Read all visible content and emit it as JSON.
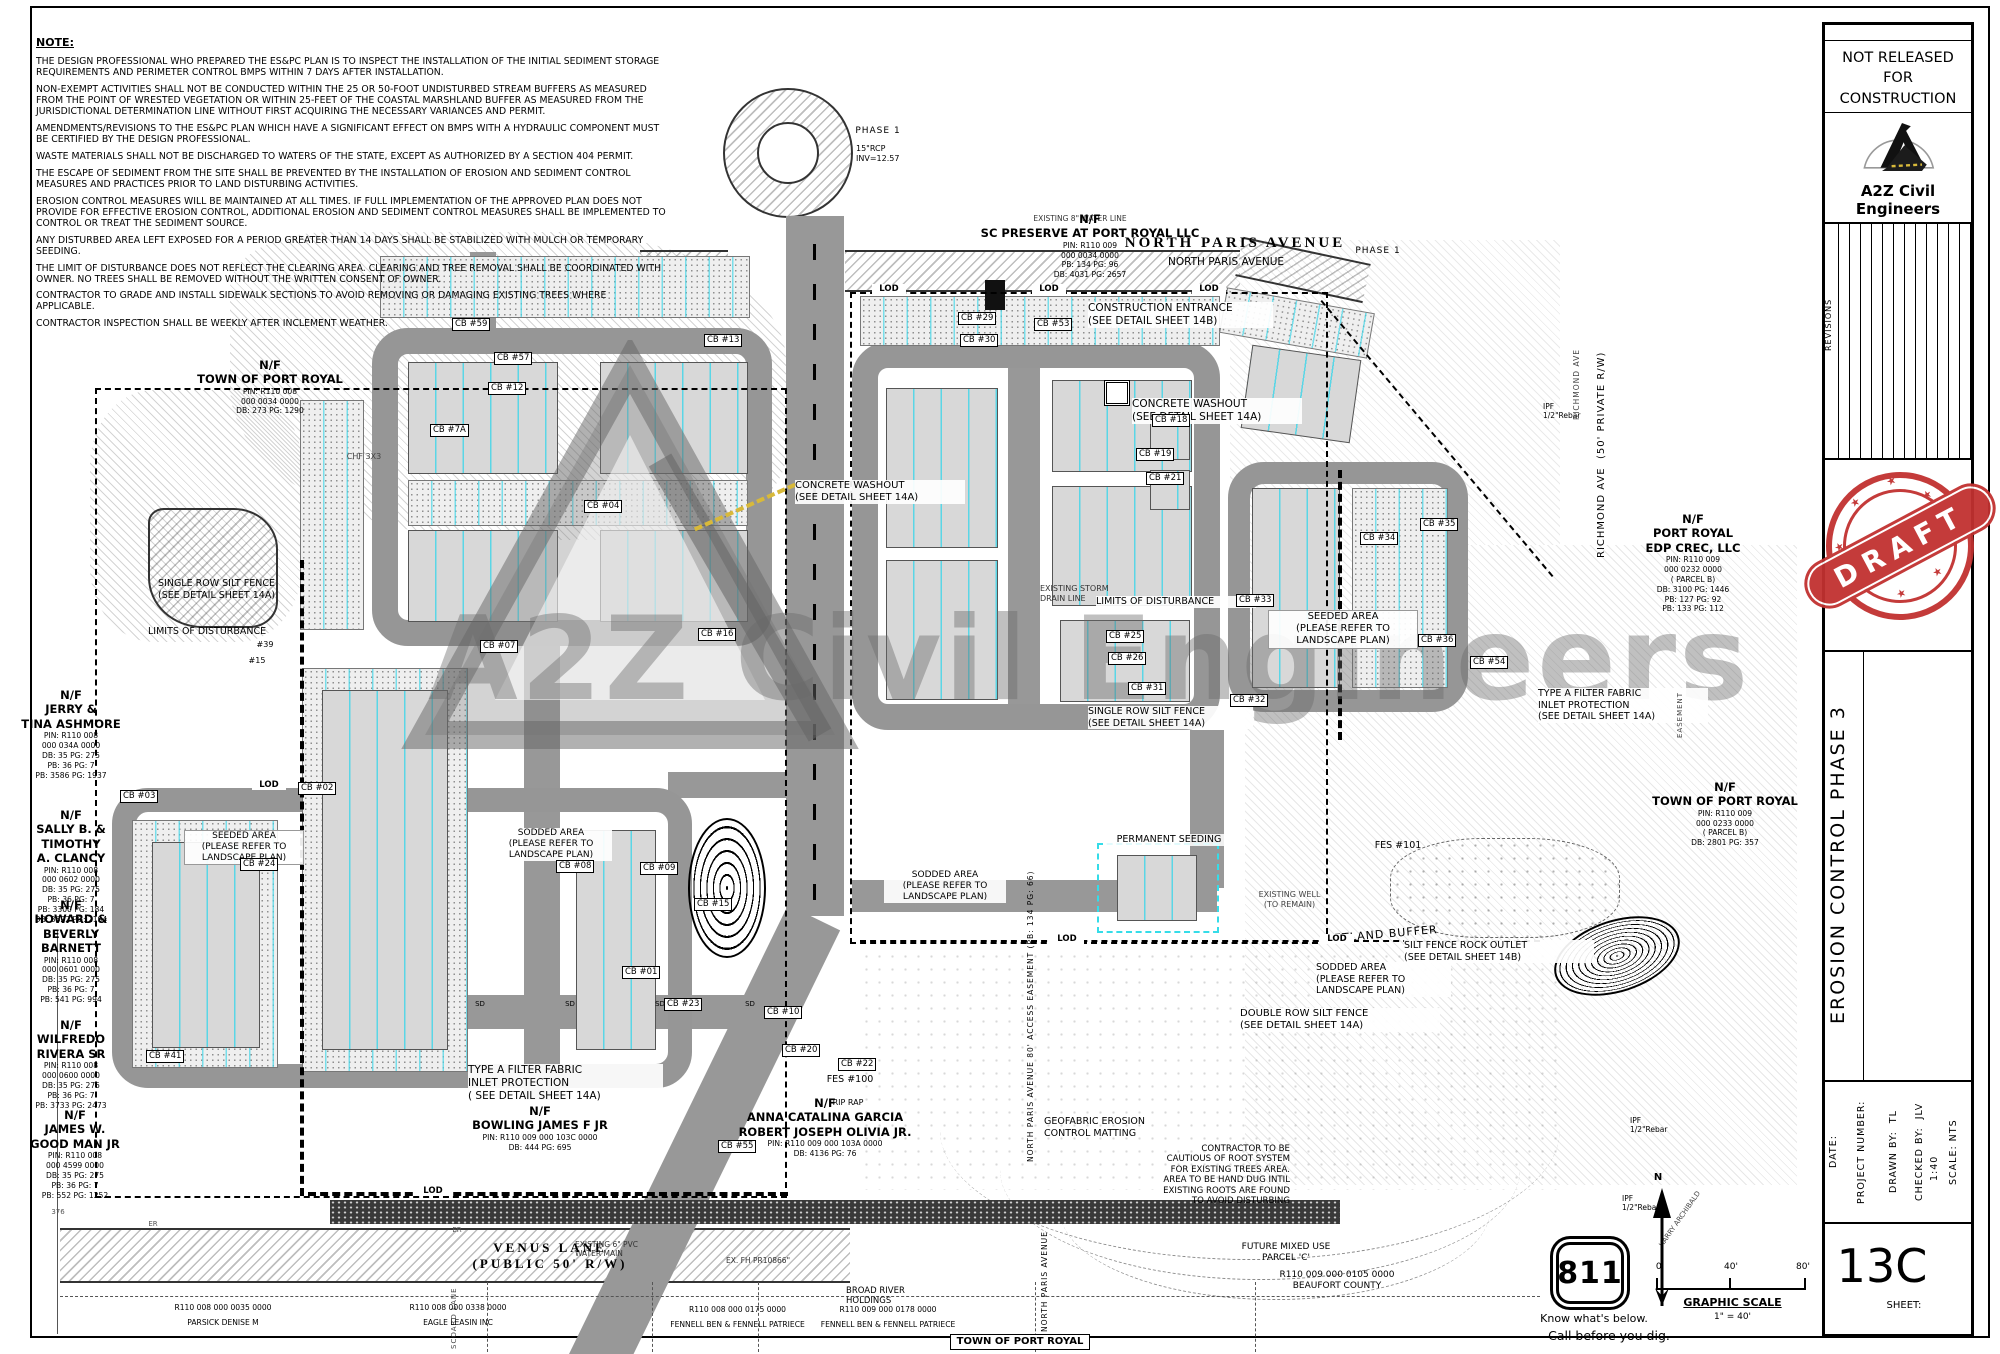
{
  "notes": {
    "title": "NOTE:",
    "items": [
      "THE DESIGN PROFESSIONAL WHO PREPARED THE ES&PC PLAN IS TO INSPECT THE INSTALLATION OF THE INITIAL SEDIMENT  STORAGE REQUIREMENTS AND PERIMETER CONTROL BMPS WITHIN 7 DAYS AFTER INSTALLATION.",
      "NON-EXEMPT ACTIVITIES SHALL NOT BE CONDUCTED WITHIN THE 25 OR 50-FOOT UNDISTURBED STREAM BUFFERS AS MEASURED FROM THE POINT OF WRESTED VEGETATION OR WITHIN 25-FEET OF THE COASTAL MARSHLAND BUFFER AS MEASURED FROM THE JURISDICTIONAL DETERMINATION LINE WITHOUT FIRST ACQUIRING THE NECESSARY VARIANCES AND PERMIT.",
      "AMENDMENTS/REVISIONS TO THE ES&PC PLAN WHICH HAVE A SIGNIFICANT EFFECT ON BMPS WITH A HYDRAULIC COMPONENT MUST BE CERTIFIED BY THE DESIGN PROFESSIONAL.",
      "WASTE MATERIALS SHALL NOT BE DISCHARGED TO WATERS OF THE STATE, EXCEPT AS AUTHORIZED BY A  SECTION 404 PERMIT.",
      "THE ESCAPE OF SEDIMENT FROM THE SITE SHALL BE PREVENTED BY THE INSTALLATION OF EROSION AND SEDIMENT CONTROL MEASURES AND PRACTICES PRIOR TO LAND DISTURBING ACTIVITIES.",
      "EROSION CONTROL MEASURES WILL BE MAINTAINED AT ALL TIMES.  IF FULL IMPLEMENTATION OF THE APPROVED PLAN DOES NOT PROVIDE FOR EFFECTIVE EROSION CONTROL, ADDITIONAL EROSION AND SEDIMENT CONTROL MEASURES SHALL BE IMPLEMENTED TO CONTROL OR TREAT THE SEDIMENT SOURCE.",
      "ANY DISTURBED AREA LEFT EXPOSED FOR A PERIOD GREATER THAN 14 DAYS SHALL BE STABILIZED WITH MULCH OR TEMPORARY SEEDING.",
      "THE LIMIT OF DISTURBANCE DOES NOT REFLECT THE CLEARING AREA.  CLEARING AND TREE REMOVAL SHALL BE COORDINATED WITH OWNER.  NO TREES SHALL BE REMOVED WITHOUT THE WRITTEN CONSENT OF OWNER.",
      "CONTRACTOR TO GRADE AND INSTALL SIDEWALK SECTIONS TO AVOID REMOVING OR DAMAGING EXISTING TREES WHERE APPLICABLE.",
      "CONTRACTOR INSPECTION SHALL BE WEEKLY AFTER INCLEMENT WEATHER."
    ]
  },
  "plan": {
    "watermark": "A2Z Civil Engineers",
    "lod": "LOD",
    "sd": "SD",
    "owners": [
      {
        "name": "N/F\nTOWN OF PORT ROYAL",
        "details": "PIN: R110 008\n000 0034 0000\nDB: 273      PG: 1290"
      },
      {
        "name": "N/F\nJERRY &\nTINA ASHMORE",
        "details": "PIN: R110 008\n000 034A 0000\nDB: 35        PG: 275\nPB: 36         PG: 7\nPB: 3586    PG: 1937"
      },
      {
        "name": "N/F\nSALLY B. &\nTIMOTHY\nA. CLANCY",
        "details": "PIN: R110 008\n000 0602 0000\nDB: 35        PG: 275\nPB: 36         PG: 7\nPB: 3300    PG: 184\nDB: 3622    PG: 2194"
      },
      {
        "name": "N/F\nHOWARD &\nBEVERLY\nBARNETT",
        "details": "PIN: R110 008\n000 0601 0000\nDB: 35        PG: 275\nPB: 36         PG: 7\nPB: 541      PG: 994"
      },
      {
        "name": "N/F\nWILFREDO\nRIVERA SR",
        "details": "PIN: R110 008\n000 0600 0000\nDB: 35        PG: 275\nPB: 36         PG: 7\nPB: 3733    PG: 2473"
      },
      {
        "name": "N/F\nJAMES W.\nGOOD MAN JR",
        "details": "PIN: R110 008\n000 4599 0000\nDB: 35        PG: 275\nPB: 36         PG: 7\nPB: 552      PG: 1252"
      },
      {
        "name": "N/F\nBOWLING JAMES F JR",
        "details": "PIN: R110 009 000 103C 0000\nDB: 444        PG: 695"
      },
      {
        "name": "N/F\nANNA CATALINA GARCIA\nROBERT JOSEPH OLIVIA JR.",
        "details": "PIN: R110 009 000 103A 0000\nDB: 4136     PG: 76"
      },
      {
        "name": "N/F\nSC PRESERVE AT PORT ROYAL LLC",
        "details": "PIN: R110 009\n000 0034 0000\nPB: 134      PG: 96\nDB: 4031    PG: 2657"
      },
      {
        "name": "N/F\nPORT ROYAL\nEDP CREC, LLC",
        "details": "PIN: R110 009\n000 0232 0000\n( PARCEL B)\nDB: 3100     PG: 1446\nPB: 127        PG: 92\nPB: 133        PG: 112"
      },
      {
        "name": "N/F\nTOWN OF PORT ROYAL",
        "details": "PIN: R110 009\n000 0233 0000\n( PARCEL B)\nDB: 2801     PG: 357"
      }
    ],
    "callouts": [
      "CONSTRUCTION ENTRANCE\n(SEE DETAIL SHEET 14B)",
      "CONCRETE WASHOUT\n(SEE DETAIL SHEET 14A)",
      "CONCRETE WASHOUT\n(SEE DETAIL SHEET 14A)",
      "SINGLE ROW SILT FENCE\n(SEE DETAIL SHEET 14A)",
      "LIMITS OF DISTURBANCE",
      "SEEDED AREA\n(PLEASE REFER TO\nLANDSCAPE PLAN)",
      "SODDED AREA\n(PLEASE REFER TO\nLANDSCAPE PLAN)",
      "EXISTING STORM\nDRAIN LINE",
      "LIMITS OF DISTURBANCE",
      "SINGLE ROW SILT FENCE\n(SEE DETAIL SHEET 14A)",
      "SEEDED AREA\n(PLEASE REFER TO\nLANDSCAPE PLAN)",
      "PERMANENT SEEDING",
      "SODDED AREA\n(PLEASE REFER TO\nLANDSCAPE PLAN)",
      "WETLAND BUFFER",
      "SILT FENCE ROCK OUTLET\n(SEE DETAIL SHEET 14B)",
      "SODDED AREA\n(PLEASE REFER TO\nLANDSCAPE PLAN)",
      "DOUBLE ROW SILT FENCE\n(SEE DETAIL SHEET 14A)",
      "TYPE A FILTER FABRIC\nINLET PROTECTION\n(SEE DETAIL SHEET 14A)",
      "TYPE A FILTER FABRIC\nINLET PROTECTION\n( SEE DETAIL SHEET 14A)",
      "EXISTING WELL\n(TO REMAIN)",
      "GEOFABRIC EROSION\nCONTROL MATTING",
      "CONTRACTOR TO BE\nCAUTIOUS OF ROOT SYSTEM\nFOR EXISTING TREES AREA.\nAREA TO BE HAND DUG INTIL\nEXISTING ROOTS ARE FOUND\nTO AVOID DISTURBING",
      "RIP RAP",
      "FES #100",
      "FES #101",
      "PHASE 1",
      "PHASE 1",
      "15\"RCP\nINV=12.57",
      "EXISTING 8\" WATER LINE",
      "EXISTING 6\" PVC\nWATER MAIN",
      "EX. FH PR10866\"",
      "FUTURE MIXED USE\nPARCEL 'C'",
      "R110 009 000 0105 0000\nBEAUFORT COUNTY",
      "BROAD RIVER\nHOLDINGS",
      "IPF\n1/2\"Rebar",
      "IPF\n1/2\"Rebar",
      "IPF\n1/2\"Rebar",
      "CHF 3X3",
      "#39",
      "#15",
      "ER",
      "ER",
      "376",
      "TOWN OF PORT ROYAL",
      "HARRY ARCHIBALD",
      "EASEMENT"
    ],
    "cbs": [
      "CB #7A",
      "CB #59",
      "CB #57",
      "CB #12",
      "CB #13",
      "CB #04",
      "CB #07",
      "CB #08",
      "CB #09",
      "CB #15",
      "CB #16",
      "CB #10",
      "CB #20",
      "CB #22",
      "CB #23",
      "CB #55",
      "CB #29",
      "CB #30",
      "CB #53",
      "CB #18",
      "CB #19",
      "CB #21",
      "CB #33",
      "CB #25",
      "CB #26",
      "CB #31",
      "CB #32",
      "CB #34",
      "CB #35",
      "CB #36",
      "CB #54",
      "CB #41",
      "CB #03",
      "CB #02",
      "CB #24",
      "CB #01"
    ],
    "roads": [
      "NORTH PARIS AVENUE",
      "NORTH PARIS AVENUE",
      "VENUS LANE\n(PUBLIC 50' R/W)",
      "RICHMOND AVE  (50' PRIVATE R/W)",
      "RICHMOND AVE",
      "NORTH PARIS AVENUE 80' ACCESS EASEMENT (PB: 134 PG: 66)",
      "NORTH PARIS AVENUE",
      "SCOARD LANE"
    ],
    "parcels": [
      "R110 008 000 0035 0000\nPARSICK DENISE M",
      "R110 008 000 0338 0000\nEAGLE LEASIN INC",
      "R110 008 000 0175 0000\nFENNELL BEN & FENNELL PATRIECE",
      "R110 009 000 0178 0000\nFENNELL BEN & FENNELL PATRIECE"
    ]
  },
  "title_block": {
    "release": "NOT RELEASED\nFOR\nCONSTRUCTION",
    "company": "A2Z Civil Engineers",
    "revisions": "REVISIONS",
    "stamp": "DRAFT",
    "sheet_title": "EROSION CONTROL PHASE 3",
    "date_label": "DATE:",
    "project_label": "PROJECT NUMBER:",
    "drawn_label": "DRAWN BY:  TL",
    "checked_label": "CHECKED BY:  JLV",
    "checked_scale": "1:40",
    "scale_label": "SCALE: NTS",
    "sheet_number": "13C",
    "sheet_label": "SHEET:"
  },
  "utility": {
    "dig_number": "811",
    "know": "Know what's below.",
    "call": "Call before you dig.",
    "graphic_scale": "GRAPHIC SCALE",
    "ratio": "1\" = 40'",
    "tick0": "0'",
    "tick40": "40'",
    "tick80": "80'",
    "north": "N"
  }
}
